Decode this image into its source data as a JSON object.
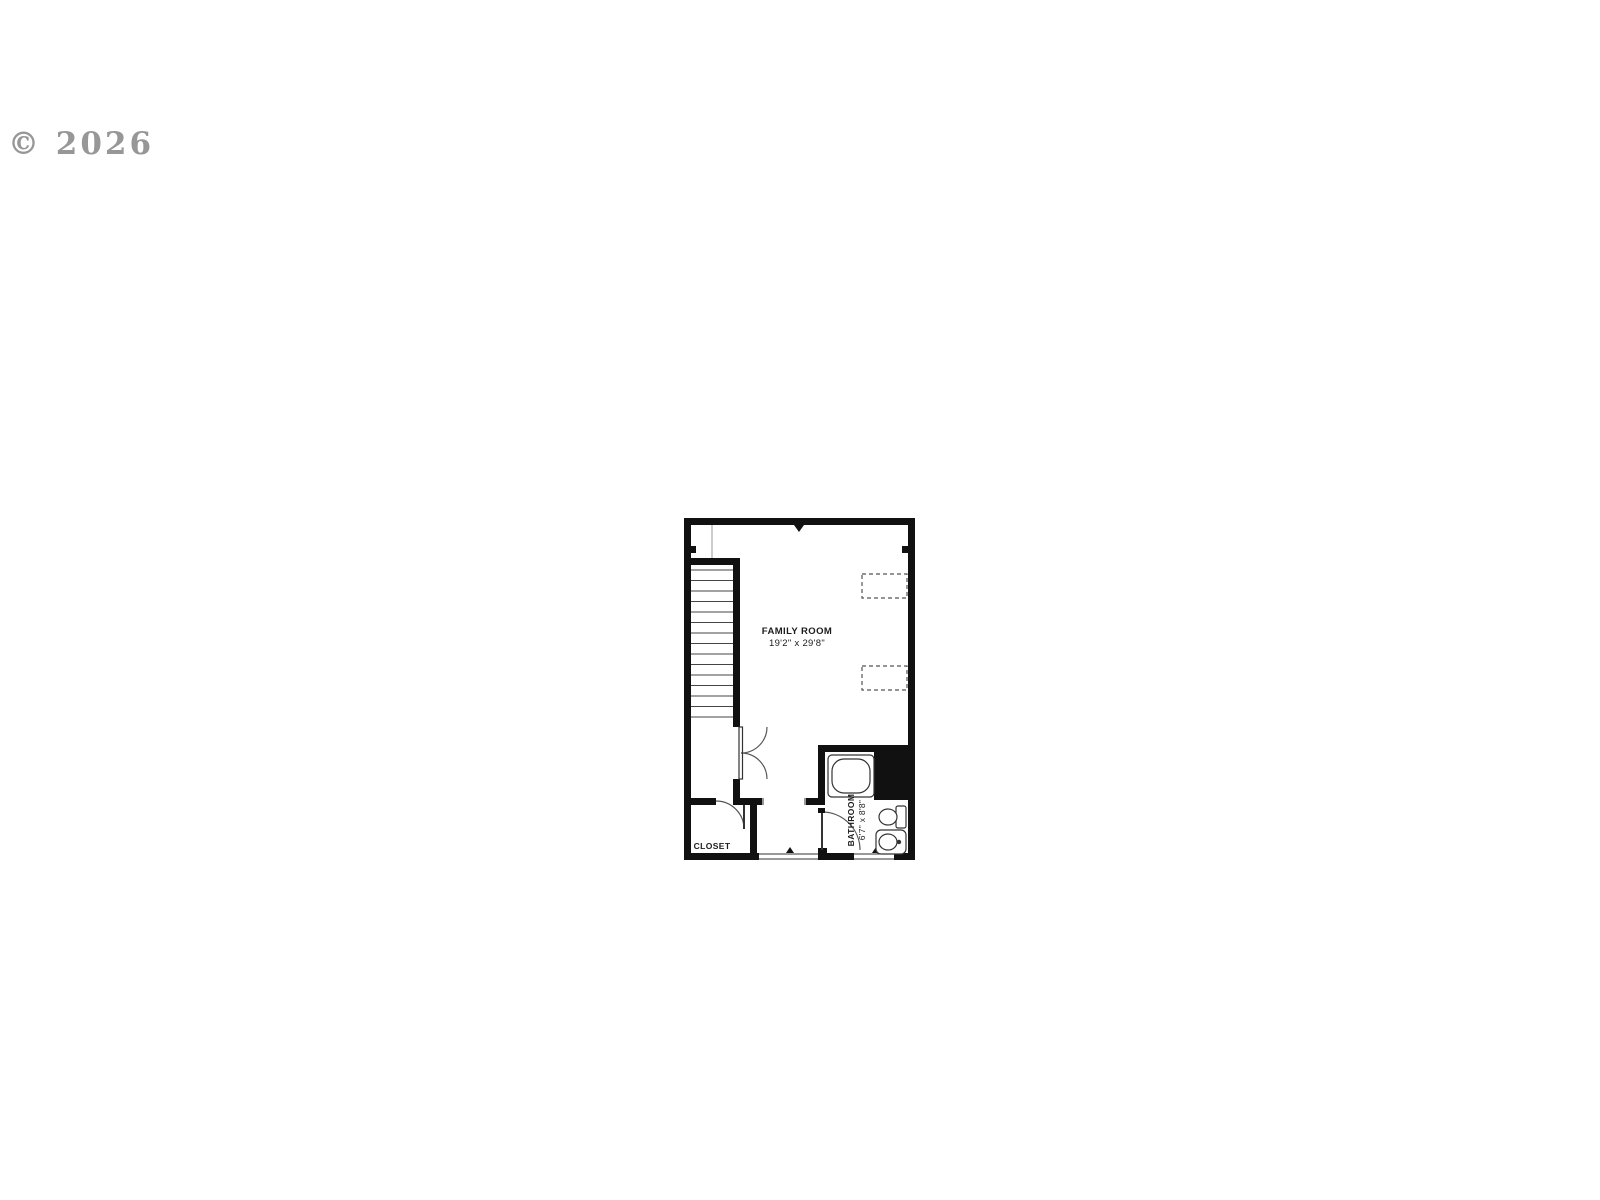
{
  "watermark": {
    "text": "© 2026"
  },
  "floor_plan": {
    "rooms": {
      "family_room": {
        "name": "FAMILY ROOM",
        "dimensions": "19'2\" x 29'8\""
      },
      "closet": {
        "name": "CLOSET"
      },
      "bathroom": {
        "name": "BATHROOM",
        "dimensions": "6'7\" x 8'8\""
      }
    },
    "fixtures": [
      "staircase",
      "understair-double-door",
      "closet-door",
      "bathroom-door",
      "bathtub",
      "toilet",
      "sink"
    ],
    "colors": {
      "wall": "#111111",
      "background": "#ffffff",
      "watermark_gray": "#8f8f8f",
      "thin_line": "#444444"
    }
  }
}
